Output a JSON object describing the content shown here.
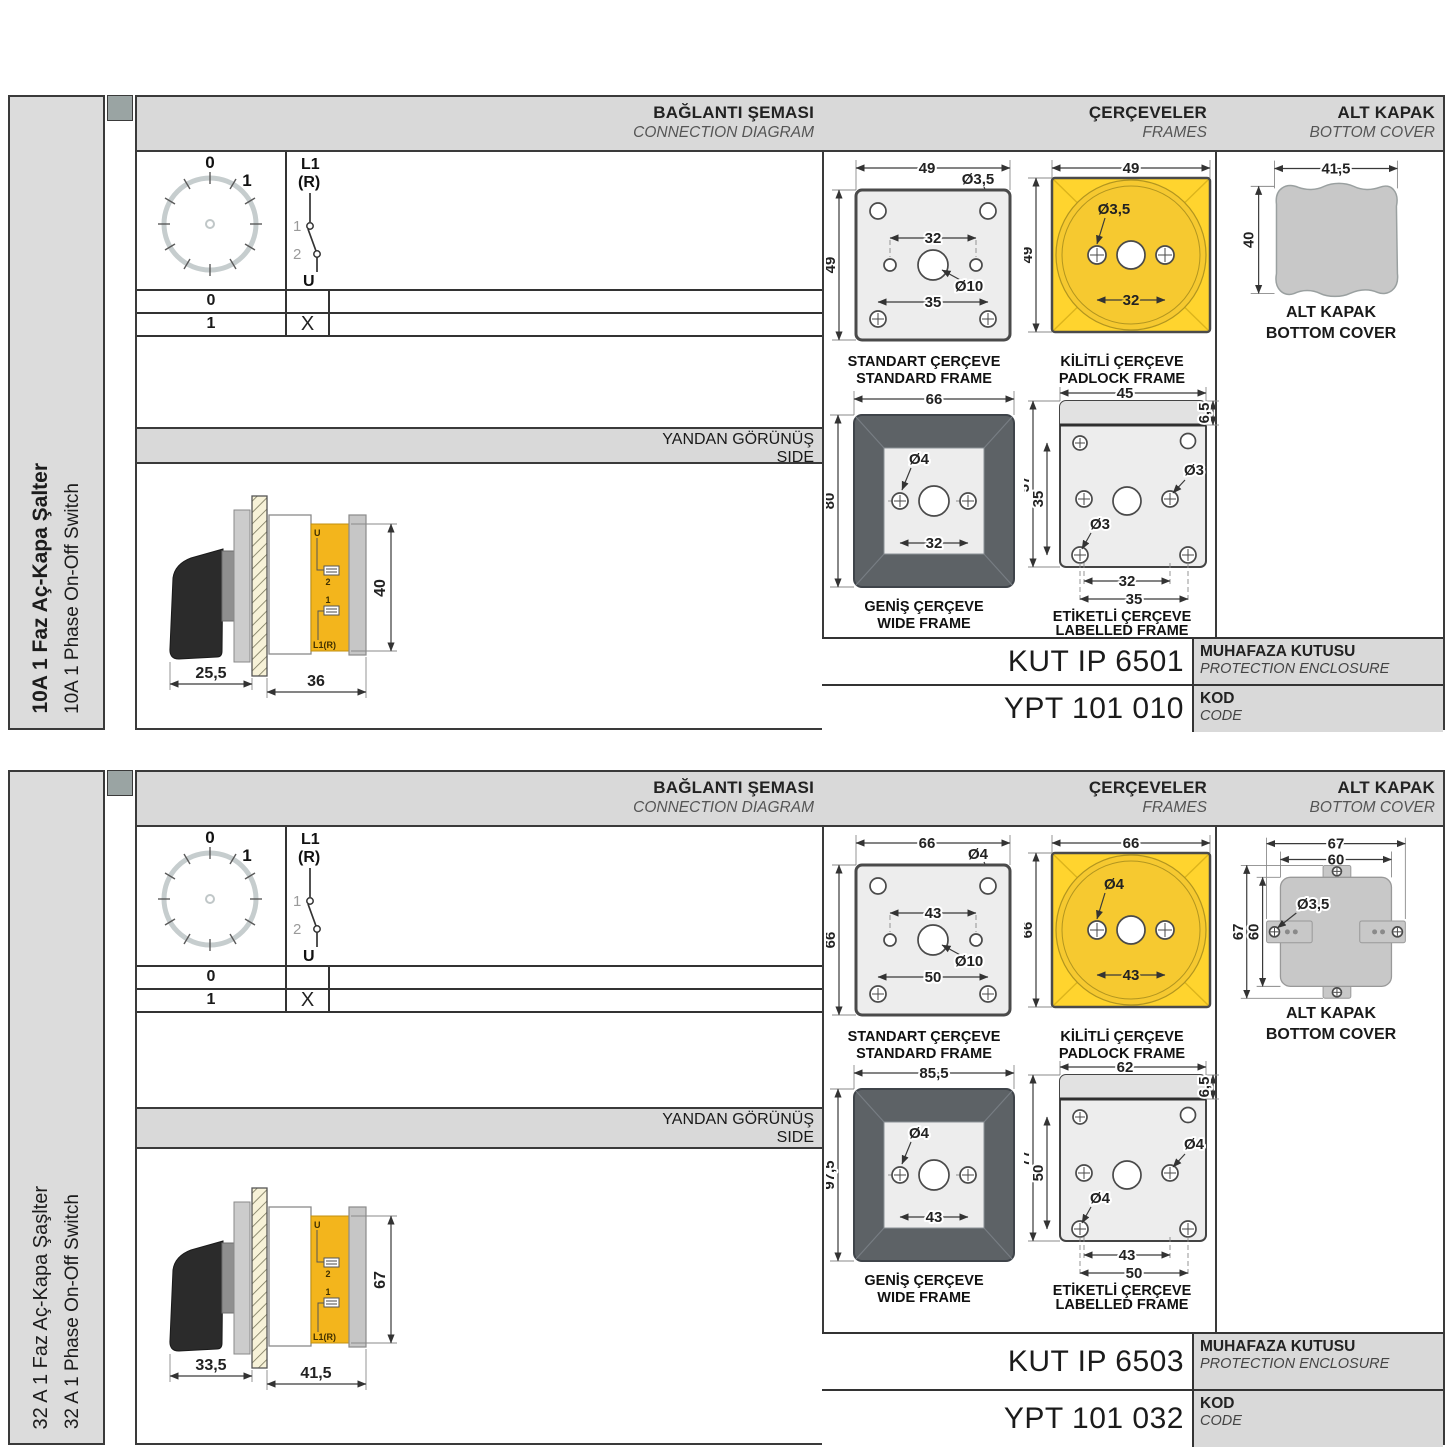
{
  "sections": [
    {
      "sidebar": {
        "title": "10A 1 Faz Aç-Kapa Şalter",
        "subtitle": "10A 1 Phase On-Off Switch"
      },
      "headers": {
        "connection": {
          "tr": "BAĞLANTI ŞEMASI",
          "en": "CONNECTION DIAGRAM"
        },
        "frames": {
          "tr": "ÇERÇEVELER",
          "en": "FRAMES"
        },
        "cover": {
          "tr": "ALT KAPAK",
          "en": "BOTTOM COVER"
        },
        "side": {
          "tr": "YANDAN GÖRÜNÜŞ",
          "en": "SIDE"
        }
      },
      "diagram": {
        "dial": {
          "pos0": "0",
          "pos1": "1"
        },
        "switch": {
          "in1": "L1",
          "in2": "(R)",
          "c1": "1",
          "c2": "2",
          "out": "U"
        },
        "rows": [
          {
            "pos": "0",
            "mark": ""
          },
          {
            "pos": "1",
            "mark": "X"
          }
        ]
      },
      "side_view": {
        "dim_knob": "25,5",
        "dim_body": "36",
        "dim_height": "40",
        "lbl_u": "U",
        "lbl_2": "2",
        "lbl_1": "1",
        "lbl_l1r": "L1(R)"
      },
      "frames": {
        "standard": {
          "w": "49",
          "h": "49",
          "inner": "32",
          "lower": "35",
          "corner_hole": "Ø3,5",
          "center_hole": "Ø10",
          "cap_tr": "STANDART ÇERÇEVE",
          "cap_en": "STANDARD FRAME"
        },
        "padlock": {
          "w": "49",
          "h": "49",
          "inner": "32",
          "hole": "Ø3,5",
          "cap_tr": "KİLİTLİ ÇERÇEVE",
          "cap_en": "PADLOCK FRAME"
        },
        "wide": {
          "w": "66",
          "h": "80",
          "inner": "32",
          "hole": "Ø4",
          "cap_tr": "GENİŞ ÇERÇEVE",
          "cap_en": "WIDE FRAME"
        },
        "labelled": {
          "w": "45",
          "strip": "6,5",
          "h": "57",
          "inner_h": "35",
          "hole_right": "Ø3",
          "hole_left": "Ø3",
          "dim_inner": "32",
          "dim_outer": "35",
          "cap_tr": "ETİKETLİ ÇERÇEVE",
          "cap_en": "LABELLED FRAME"
        }
      },
      "cover": {
        "w": "41,5",
        "h": "40",
        "cap_tr": "ALT KAPAK",
        "cap_en": "BOTTOM COVER"
      },
      "codes": {
        "enclosure": "KUT IP 6501",
        "enclosure_tr": "MUHAFAZA KUTUSU",
        "enclosure_en": "PROTECTION ENCLOSURE",
        "code": "YPT 101 010",
        "code_tr": "KOD",
        "code_en": "CODE"
      }
    },
    {
      "sidebar": {
        "title": "32 A 1 Faz Aç-Kapa Şaşlter",
        "subtitle": "32 A 1 Phase On-Off Switch"
      },
      "headers": {
        "connection": {
          "tr": "BAĞLANTI ŞEMASI",
          "en": "CONNECTION DIAGRAM"
        },
        "frames": {
          "tr": "ÇERÇEVELER",
          "en": "FRAMES"
        },
        "cover": {
          "tr": "ALT KAPAK",
          "en": "BOTTOM COVER"
        },
        "side": {
          "tr": "YANDAN GÖRÜNÜŞ",
          "en": "SIDE"
        }
      },
      "diagram": {
        "dial": {
          "pos0": "0",
          "pos1": "1"
        },
        "switch": {
          "in1": "L1",
          "in2": "(R)",
          "c1": "1",
          "c2": "2",
          "out": "U"
        },
        "rows": [
          {
            "pos": "0",
            "mark": ""
          },
          {
            "pos": "1",
            "mark": "X"
          }
        ]
      },
      "side_view": {
        "dim_knob": "33,5",
        "dim_body": "41,5",
        "dim_height": "67",
        "lbl_u": "U",
        "lbl_2": "2",
        "lbl_1": "1",
        "lbl_l1r": "L1(R)"
      },
      "frames": {
        "standard": {
          "w": "66",
          "h": "66",
          "inner": "43",
          "lower": "50",
          "corner_hole": "Ø4",
          "center_hole": "Ø10",
          "cap_tr": "STANDART ÇERÇEVE",
          "cap_en": "STANDARD FRAME"
        },
        "padlock": {
          "w": "66",
          "h": "66",
          "inner": "43",
          "hole": "Ø4",
          "cap_tr": "KİLİTLİ ÇERÇEVE",
          "cap_en": "PADLOCK FRAME"
        },
        "wide": {
          "w": "85,5",
          "h": "97,5",
          "inner": "43",
          "hole": "Ø4",
          "cap_tr": "GENİŞ ÇERÇEVE",
          "cap_en": "WIDE FRAME"
        },
        "labelled": {
          "w": "62",
          "strip": "6,5",
          "h": "77",
          "inner_h": "50",
          "hole_right": "Ø4",
          "hole_left": "Ø4",
          "dim_inner": "43",
          "dim_outer": "50",
          "cap_tr": "ETİKETLİ ÇERÇEVE",
          "cap_en": "LABELLED FRAME"
        }
      },
      "cover": {
        "w_outer": "67",
        "w_inner": "60",
        "h_outer": "67",
        "h_inner": "60",
        "hole": "Ø3,5",
        "cap_tr": "ALT KAPAK",
        "cap_en": "BOTTOM COVER"
      },
      "codes": {
        "enclosure": "KUT IP 6503",
        "enclosure_tr": "MUHAFAZA KUTUSU",
        "enclosure_en": "PROTECTION ENCLOSURE",
        "code": "YPT 101 032",
        "code_tr": "KOD",
        "code_en": "CODE"
      }
    }
  ]
}
